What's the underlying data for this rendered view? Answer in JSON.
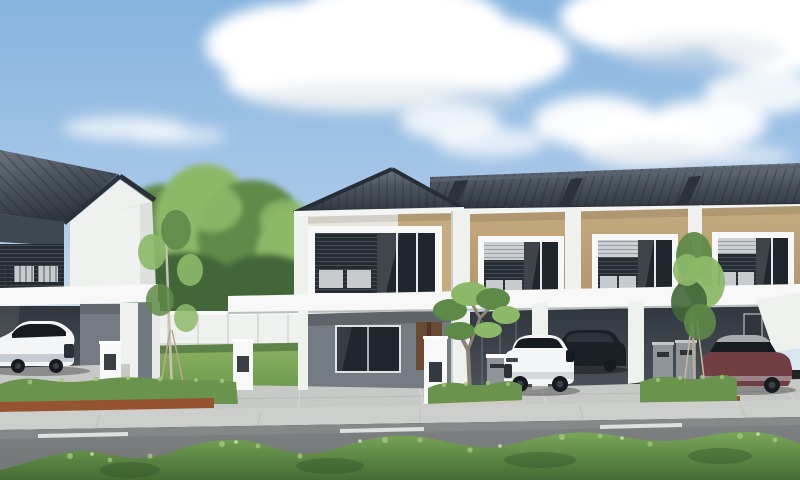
{
  "scene": {
    "type": "architectural exterior rendering",
    "subject": "Row of modern two-storey terrace houses with a gable-roof corner unit, carports with parked cars, garden, hedges and street in the foreground",
    "time_of_day": "day",
    "visible_text": "none"
  },
  "palette": {
    "sky_top": "#86B3DF",
    "sky_mid": "#A9C8E8",
    "sky_low": "#DCE9F4",
    "cloud": "#FFFFFF",
    "cloud_shade": "#D9E1E9",
    "roof": "#4A525C",
    "roof_dark": "#2E353E",
    "roof_light": "#6A727C",
    "fascia": "#F3F5F4",
    "wall_white": "#EFF1EF",
    "wall_cream": "#E9E7DD",
    "wall_shade": "#D8DCDC",
    "tan": "#C6AB81",
    "tan_dark": "#B1966D",
    "frieze": "#3F4851",
    "louver": "#262C33",
    "roller": "#CDD1D3",
    "glass": "#20262D",
    "ac": "#C7CBCE",
    "slab": "#F7F8F7",
    "ground_gray": "#757B82",
    "ground_dark": "#31373E",
    "door_wood": "#6B4A33",
    "door_dark": "#2F353B",
    "pavement": "#C7C9C7",
    "sidewalk": "#CDCFCD",
    "road": "#747778",
    "road_line": "#E9EBEA",
    "curb": "#D7D9D8",
    "lawn": "#699849",
    "tree": "#5E8A48",
    "tree_light": "#8CB968",
    "tree_dark": "#436639",
    "hedge": "#6A944E",
    "hedge_light": "#A6C77C",
    "soil": "#95532F",
    "bush_dark": "#446B35",
    "bush_light": "#C3DB98",
    "trunk": "#B3A894",
    "post_gray": "#8F9599",
    "car_white": "#F3F5F6",
    "car_white_shade": "#C6CCD1",
    "car_dark": "#1B2026",
    "car_glass": "#161B21",
    "car_maroon": "#713F42",
    "car_silver": "#A7ABAE"
  },
  "objects": {
    "houses": {
      "corner_gable_unit": 1,
      "terrace_units": 4
    },
    "cars": [
      {
        "name": "white-suv-left",
        "color_key": "car_white"
      },
      {
        "name": "black-suv",
        "color_key": "car_dark"
      },
      {
        "name": "white-suv-center",
        "color_key": "car_white"
      },
      {
        "name": "maroon-sedan",
        "color_key": "car_maroon"
      }
    ],
    "vegetation": [
      "background-trees",
      "garden-lawn",
      "young-staked-trees",
      "frangipani-tree",
      "front-hedges",
      "foreground-bushes",
      "grass-verge"
    ],
    "street": [
      "driveway-pavement",
      "sidewalk",
      "asphalt-road",
      "dashed-centerline",
      "curb"
    ],
    "furniture": [
      "gate-pillars",
      "mailboxes",
      "boundary-wall",
      "carport-canopy"
    ]
  }
}
